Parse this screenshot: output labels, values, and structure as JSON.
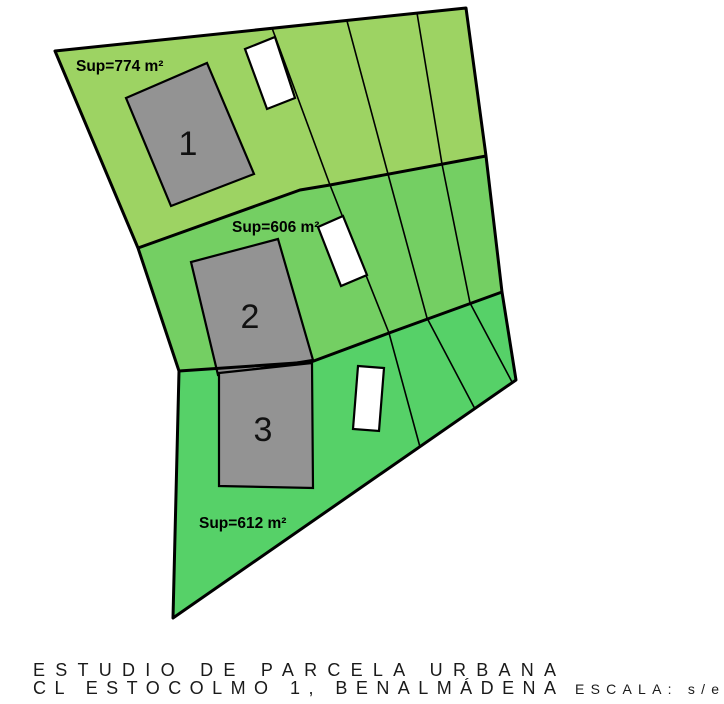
{
  "title_block": {
    "line1": "ESTUDIO DE PARCELA URBANA",
    "line2": "CL ESTOCOLMO 1, BENALMÁDENA",
    "scale": "ESCALA: s/e"
  },
  "parcels": [
    {
      "name": "Parcela 1",
      "area_label": "Sup=774 m²",
      "area_m2": 774,
      "building_number": "1",
      "fill": "#9dd363"
    },
    {
      "name": "Parcela 2",
      "area_label": "Sup=606 m²",
      "area_m2": 606,
      "building_number": "2",
      "fill": "#74cf63"
    },
    {
      "name": "Parcela 3",
      "area_label": "Sup=612 m²",
      "area_m2": 612,
      "building_number": "3",
      "fill": "#56d168"
    }
  ],
  "colors": {
    "building": "#939393",
    "pool": "#ffffff",
    "line": "#000000",
    "background": "#ffffff"
  }
}
